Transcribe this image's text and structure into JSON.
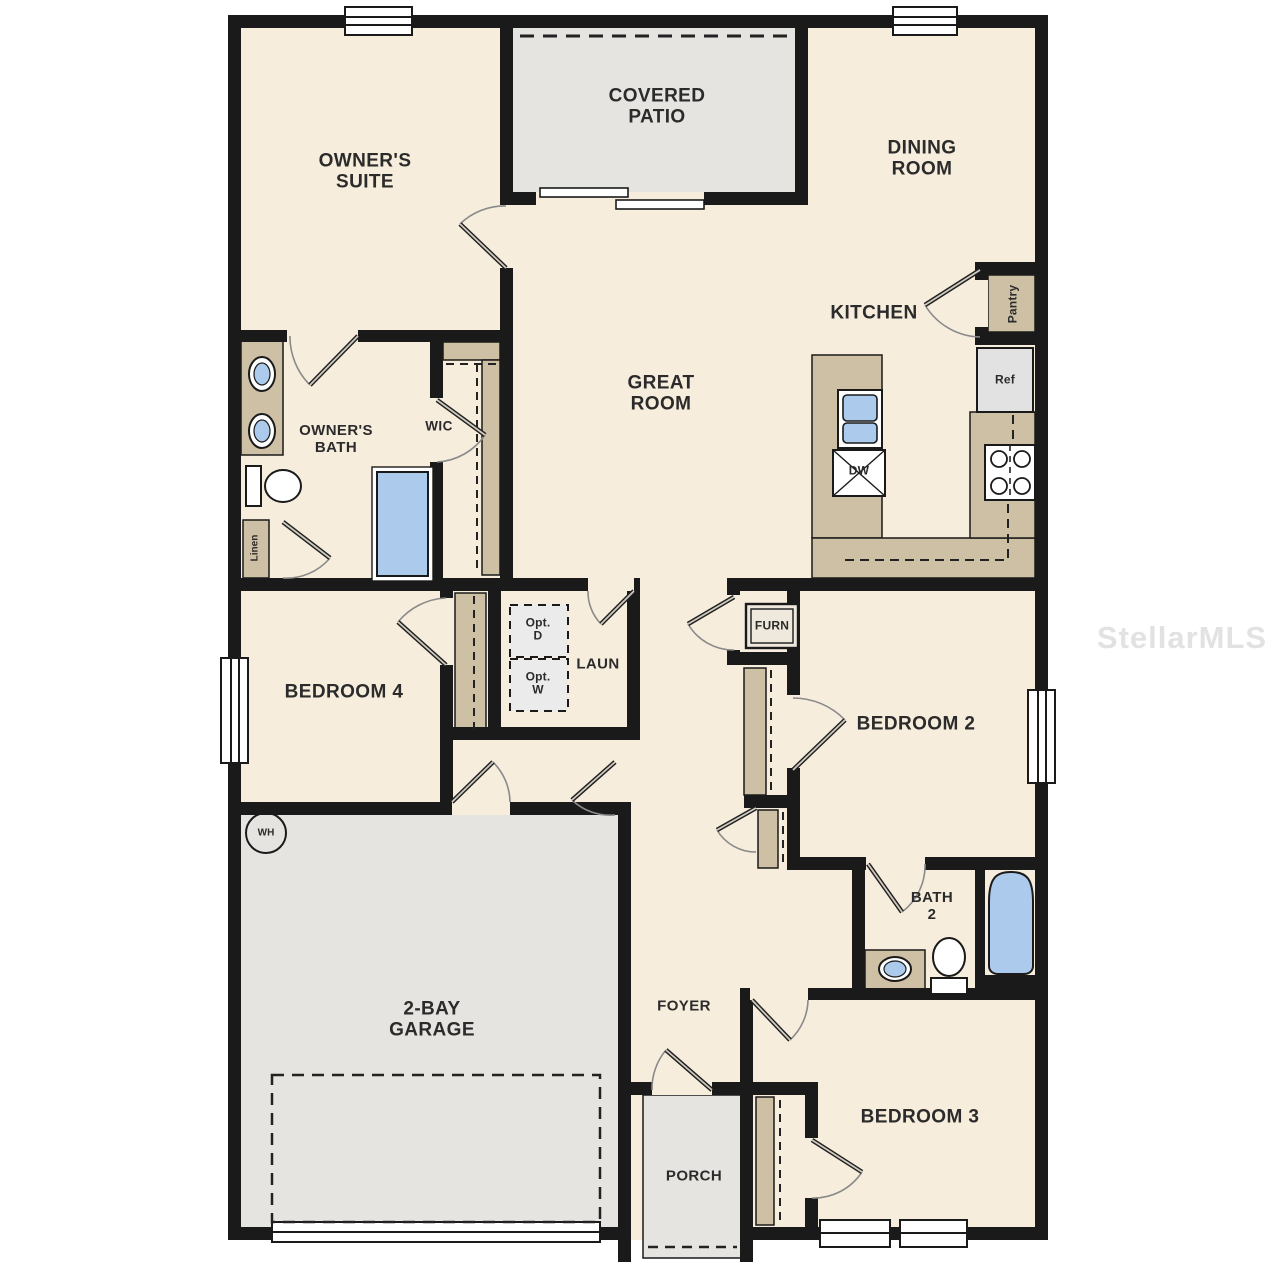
{
  "rooms": {
    "owners_suite": "OWNER'S\nSUITE",
    "covered_patio": "COVERED\nPATIO",
    "dining_room": "DINING\nROOM",
    "kitchen": "KITCHEN",
    "great_room": "GREAT\nROOM",
    "owners_bath": "OWNER'S\nBATH",
    "wic": "WIC",
    "laundry": "LAUN",
    "bedroom_4": "BEDROOM 4",
    "bedroom_2": "BEDROOM 2",
    "bath_2": "BATH\n2",
    "bedroom_3": "BEDROOM 3",
    "garage": "2-BAY\nGARAGE",
    "foyer": "FOYER",
    "porch": "PORCH"
  },
  "fixtures": {
    "pantry": "Pantry",
    "refrigerator": "Ref",
    "dishwasher": "DW",
    "furnace": "FURN",
    "optional_dryer": "Opt.\nD",
    "optional_washer": "Opt.\nW",
    "water_heater": "WH",
    "linen": "Linen"
  },
  "watermark": "StellarMLS",
  "colors": {
    "wall": "#1a1a1a",
    "floor": "#f6eddd",
    "hard_surface": "#e6e4e1",
    "counter": "#cec0a4",
    "fixture_blue": "#accaeb",
    "appliance_gray": "#e2e2e2"
  }
}
